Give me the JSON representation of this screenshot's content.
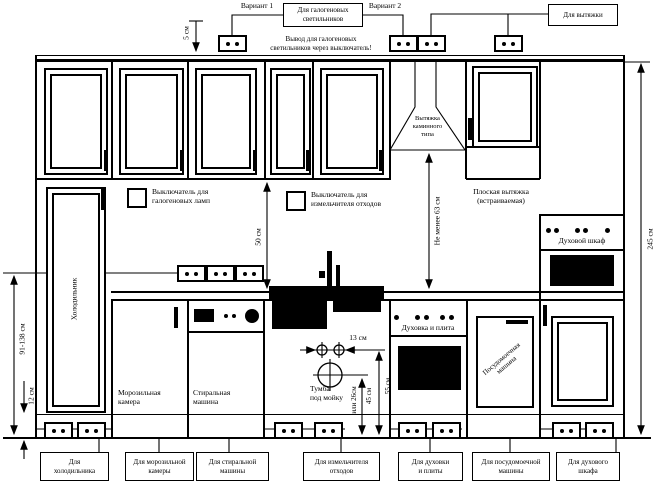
{
  "top": {
    "variant1": "Вариант 1",
    "variant2": "Вариант 2",
    "halogen_box": "Для галогеновых\nсветильников",
    "hood_box": "Для вытяжки",
    "note": "Вывод для галогеновых\nсветильников через выключатель!"
  },
  "switches": {
    "halogen": "Выключатель для\nгалогеновых ламп",
    "disposer": "Выключатель для\nизмельчителя отходов"
  },
  "appliances": {
    "chimney_hood": "Вытяжка\nкаминного\nтипа",
    "flat_hood": "Плоская вытяжка\n(встраиваемая)",
    "oven_cabinet": "Духовой шкаф",
    "fridge": "Холодильник",
    "freezer": "Морозильная\nкамера",
    "washer": "Стиральная\nмашина",
    "sink_cabinet": "Тумба\nпод мойку",
    "stove": "Духовка и плита",
    "dishwasher": "Посудомоечная\nмашина"
  },
  "dims": {
    "top_5": "5 см",
    "upper_50": "50 см",
    "hood_63": "Не менее 63 см",
    "right_245": "245 см",
    "fridge_91_138": "91-138 см",
    "plinth_12": "12 см",
    "sink_13": "13 см",
    "sink_45": "45 см",
    "sink_45_alt": "или 26см",
    "sink_55": "55 см"
  },
  "bottom_labels": [
    {
      "label": "Для\nхолодильника"
    },
    {
      "label": "Для морозильной\nкамеры"
    },
    {
      "label": "Для стиральной\nмашины"
    },
    {
      "label": "Для измельчителя\nотходов"
    },
    {
      "label": "Для духовки\nи плиты"
    },
    {
      "label": "Для посудомоечной\nмашины"
    },
    {
      "label": "Для духового\nшкафа"
    }
  ]
}
